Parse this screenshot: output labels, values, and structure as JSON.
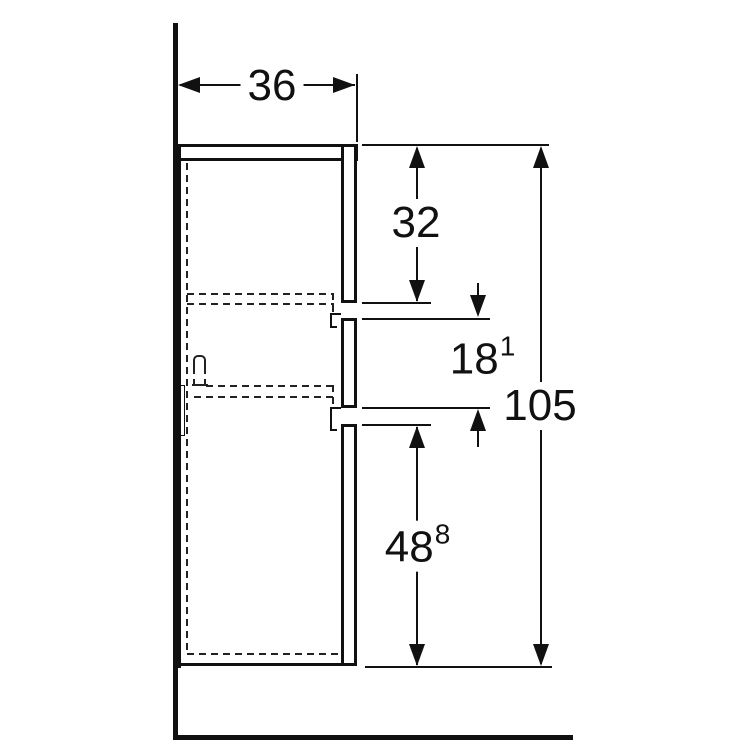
{
  "dimensions": {
    "depth": {
      "main": "36",
      "sup": ""
    },
    "top_section": {
      "main": "32",
      "sup": ""
    },
    "middle_section": {
      "main": "18",
      "sup": "1"
    },
    "bottom_section": {
      "main": "48",
      "sup": "8"
    },
    "total_height": {
      "main": "105",
      "sup": ""
    }
  },
  "colors": {
    "line": "#111111",
    "background": "#ffffff",
    "hidden_line": "#222222"
  }
}
